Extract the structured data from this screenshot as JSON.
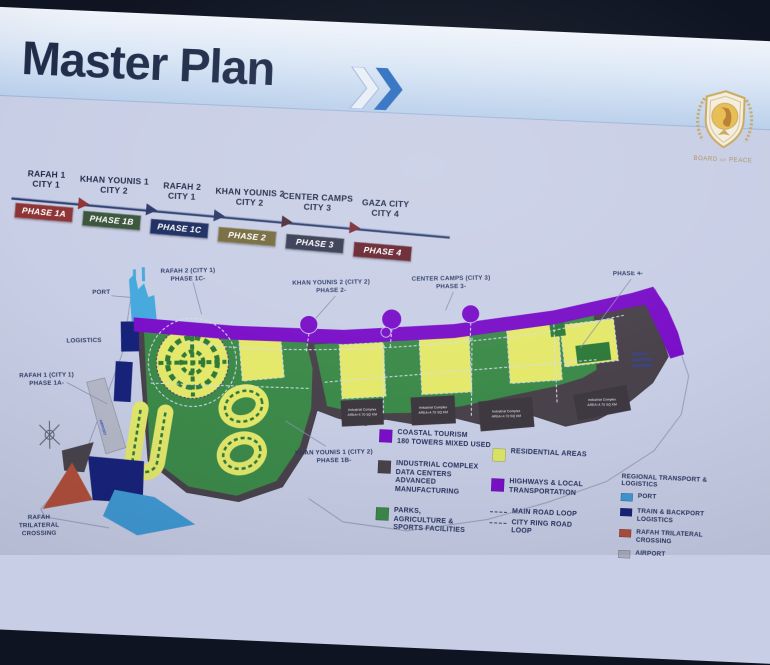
{
  "header": {
    "title": "Master Plan"
  },
  "logo": {
    "caption": "BOARD of PEACE"
  },
  "timeline": {
    "items": [
      {
        "city": "RAFAH 1",
        "sub": "CITY 1",
        "phase": "PHASE 1A",
        "color": "#8d3335"
      },
      {
        "city": "KHAN YOUNIS 1",
        "sub": "CITY 2",
        "phase": "PHASE 1B",
        "color": "#39543a"
      },
      {
        "city": "RAFAH 2",
        "sub": "CITY 1",
        "phase": "PHASE 1C",
        "color": "#1c2b5f"
      },
      {
        "city": "KHAN YOUNIS 2",
        "sub": "CITY 2",
        "phase": "PHASE 2",
        "color": "#756b3f"
      },
      {
        "city": "CENTER CAMPS",
        "sub": "CITY 3",
        "phase": "PHASE 3",
        "color": "#363b52"
      },
      {
        "city": "GAZA CITY",
        "sub": "CITY 4",
        "phase": "PHASE 4",
        "color": "#67242f"
      }
    ]
  },
  "map": {
    "labels": {
      "port": "PORT",
      "logistics": "LOGISTICS",
      "rafah1": [
        "RAFAH 1 (CITY 1)",
        "PHASE 1A-"
      ],
      "rafah2": [
        "RAFAH 2 (CITY 1)",
        "PHASE 1C-"
      ],
      "khanyounis1": [
        "KHAN YOUNIS 1 (CITY 2)",
        "PHASE 1B-"
      ],
      "khanyounis2": [
        "KHAN YOUNIS 2 (CITY 2)",
        "PHASE 2-"
      ],
      "centercamps": [
        "CENTER CAMPS (CITY 3)",
        "PHASE 3-"
      ],
      "gazacity": [
        "GAZA CITY (CITY 4)",
        "PHASE 4-"
      ],
      "crossing": [
        "RAFAH",
        "TRILATERAL",
        "CROSSING"
      ],
      "airport_strip": "AIRPORT",
      "right_edge": [
        "TRAIN &",
        "BACKPORT",
        "LOGISTICS"
      ]
    },
    "industrial": [
      {
        "l1": "Industrial Complex",
        "l2": "AREA=4.70 SQ KM"
      },
      {
        "l1": "Industrial Complex",
        "l2": "AREA=4.70 SQ KM"
      },
      {
        "l1": "Industrial Complex",
        "l2": "AREA=4.70 SQ KM"
      },
      {
        "l1": "Industrial Complex",
        "l2": "AREA=4.70 SQ KM"
      }
    ]
  },
  "legend": {
    "coastal": [
      "COASTAL TOURISM",
      "180 TOWERS MIXED USED"
    ],
    "industrial": [
      "INDUSTRIAL COMPLEX",
      "DATA CENTERS",
      "ADVANCED MANUFACTURING"
    ],
    "parks": [
      "PARKS,",
      "AGRICULTURE &",
      "SPORTS FACILITIES"
    ],
    "residential": "RESIDENTIAL AREAS",
    "highways": [
      "HIGHWAYS & LOCAL",
      "TRANSPORTATION"
    ],
    "main_road": "MAIN ROAD LOOP",
    "ring_road": [
      "CITY RING ROAD",
      "LOOP"
    ],
    "regional": {
      "title": "REGIONAL TRANSPORT & LOGISTICS",
      "port": "PORT",
      "train": [
        "TRAIN & BACKPORT",
        "LOGISTICS"
      ],
      "rafah": [
        "RAFAH TRILATERAL",
        "CROSSING"
      ],
      "airport": "AIRPORT"
    }
  },
  "colors": {
    "slide_bg": "#c8cee5",
    "title_text": "#202c49",
    "chevron_blue": "#2e6fc0",
    "highway_purple": "#7a0fc8",
    "residential_yellow": "#e4e96b",
    "parks_green": "#3c8a49",
    "industrial_gray": "#49424b",
    "port_blue": "#45a8dd",
    "train_navy": "#17227a",
    "crossing_red": "#b24f3a",
    "airport_gray": "#b6b9c8"
  }
}
